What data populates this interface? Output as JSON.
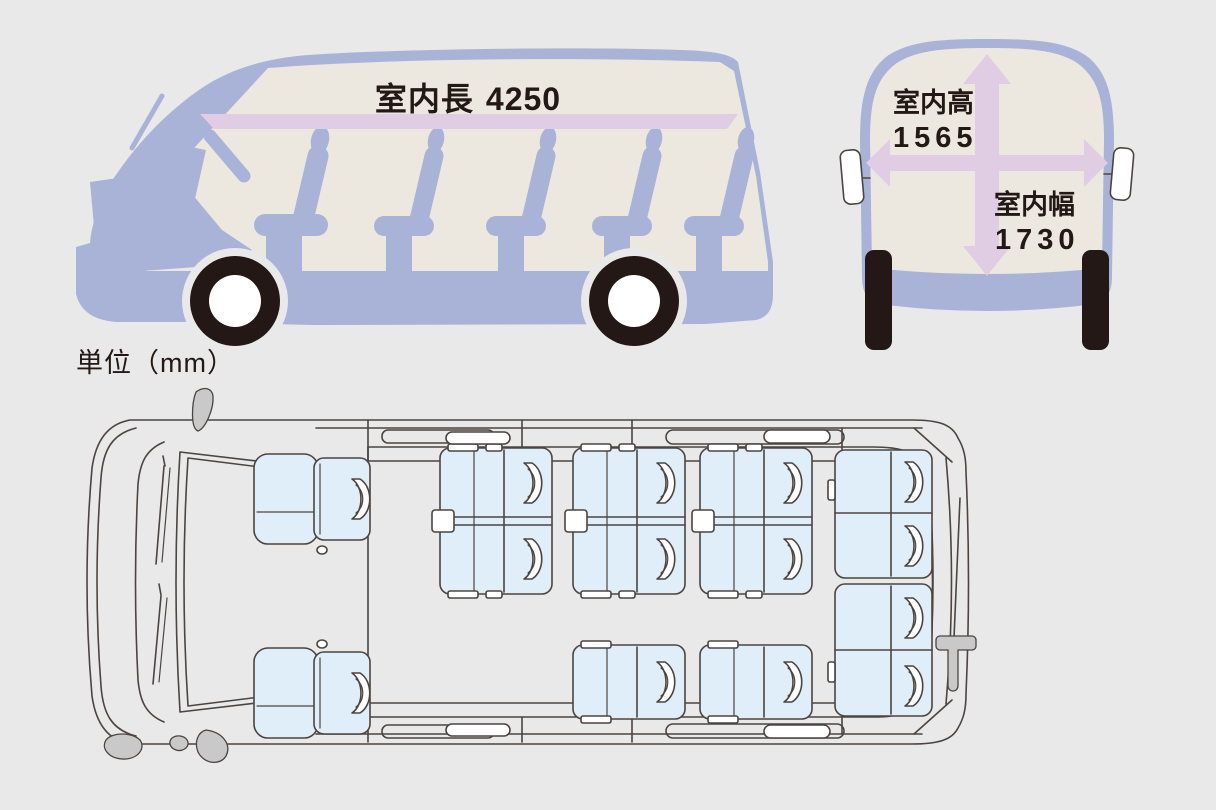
{
  "unit_label": "単位（mm）",
  "dimensions": {
    "interior_length": {
      "label": "室内長",
      "value": "4250"
    },
    "interior_height": {
      "label": "室内高",
      "value": "1565"
    },
    "interior_width": {
      "label": "室内幅",
      "value": "1730"
    }
  },
  "colors": {
    "background": "#e9e9e9",
    "body": "#a9b3d8",
    "interior": "#ece8df",
    "dimension": "#e0cce3",
    "ink": "#231815",
    "line": "#4c4440",
    "seat": "#dfeef8",
    "gray": "#c9c9ca",
    "white": "#ffffff"
  }
}
